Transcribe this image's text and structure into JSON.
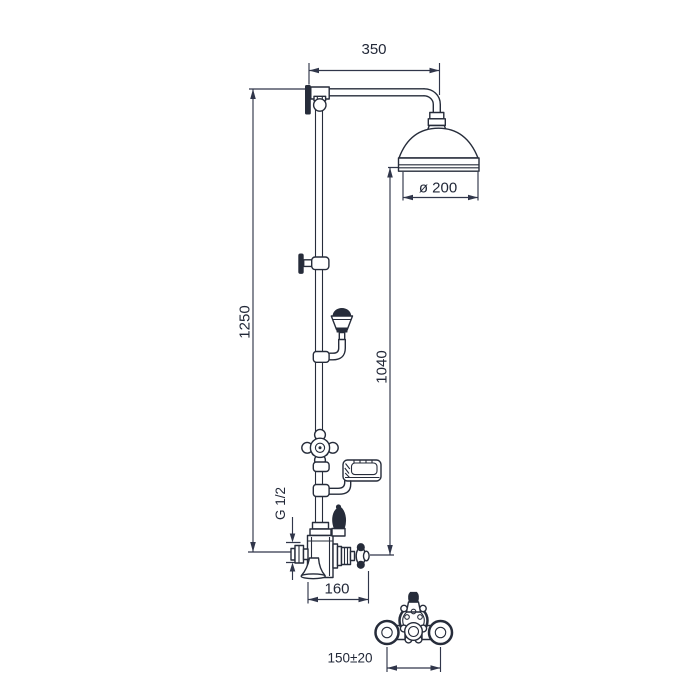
{
  "drawing": {
    "kind": "shower-column-dimension-diagram",
    "colors": {
      "line": "#262c3a",
      "dimension_line": "#30364a",
      "text": "#222838",
      "background": "#ffffff"
    }
  },
  "labels": {
    "arm_reach": "350",
    "head_diameter": "ø 200",
    "total_height": "1250",
    "head_to_valve_height": "1040",
    "connection_thread": "G 1/2",
    "valve_projection": "160",
    "inlet_spacing": "150±20"
  }
}
